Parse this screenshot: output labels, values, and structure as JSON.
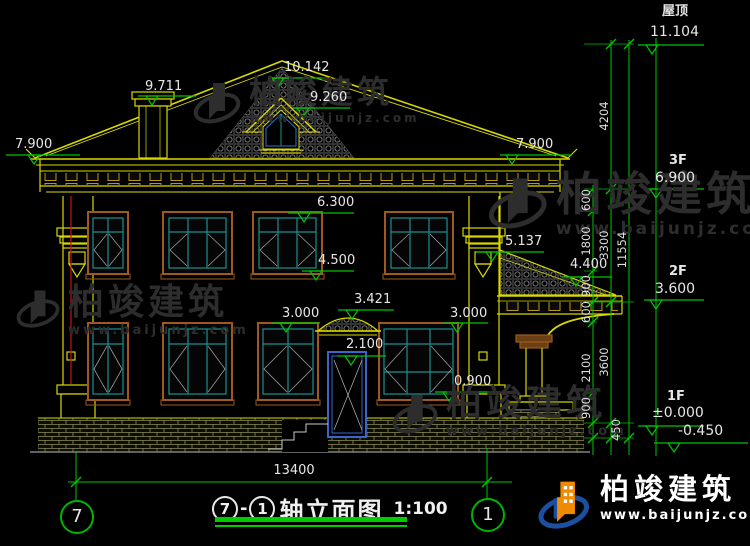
{
  "watermark": {
    "brand": "柏竣建筑",
    "site": "www.baijunjz.com"
  },
  "footer": {
    "brand": "柏竣建筑",
    "site": "www.baijunjz.com"
  },
  "levels": [
    {
      "floor": "屋顶",
      "value": "11.104"
    },
    {
      "floor": "3F",
      "value": "6.900"
    },
    {
      "floor": "2F",
      "value": "3.600"
    },
    {
      "floor": "1F",
      "value": "±0.000"
    },
    {
      "floor": "",
      "value": "-0.450"
    }
  ],
  "marks": [
    "9.711",
    "10.142",
    "9.260",
    "7.900",
    "7.900",
    "6.300",
    "4.500",
    "5.137",
    "4.400",
    "3.421",
    "3.000",
    "2.100",
    "3.000",
    "0.900"
  ],
  "dims": {
    "small": [
      "600",
      "1800",
      "900",
      "600",
      "2100",
      "900"
    ],
    "floors": [
      "4204",
      "3300",
      "3600",
      "450"
    ],
    "total": "11554",
    "width": "13400"
  },
  "axes": {
    "left": "7",
    "right": "1"
  },
  "title": {
    "from": "7",
    "to": "1",
    "dash": "-",
    "name": "轴立面图",
    "scale": "1:100"
  }
}
